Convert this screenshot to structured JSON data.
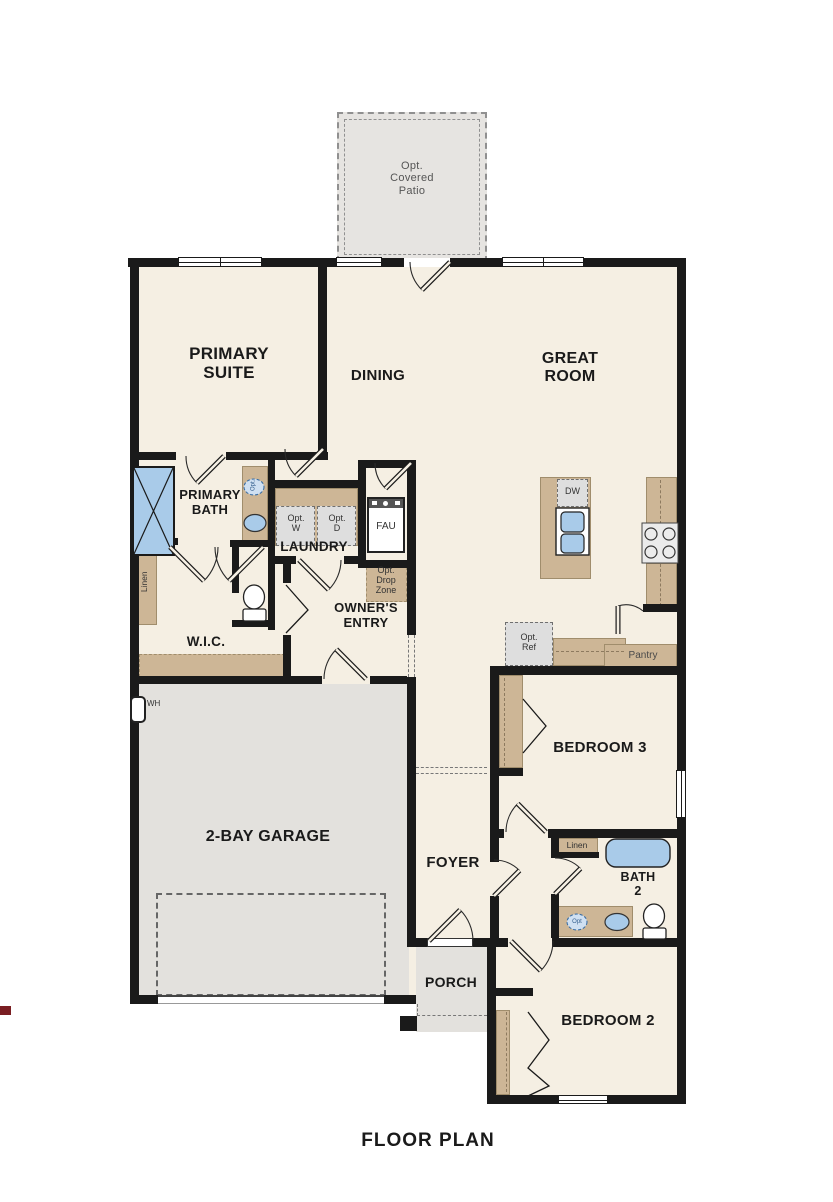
{
  "page": {
    "title": "FLOOR PLAN"
  },
  "colors": {
    "wall": "#1a1a1a",
    "room_fill": "#f5efe3",
    "garage_fill": "#e3e1dd",
    "porch_fill": "#e3e1dd",
    "patio_fill": "#e6e4e1",
    "cabinet_tan": "#cdb696",
    "optional_gray": "#dedede",
    "fixture_blue": "#a9cbe9",
    "optional_blue_outline": "#3a6ea5"
  },
  "rooms": {
    "patio": {
      "label": "Opt.\nCovered\nPatio"
    },
    "primary_suite": {
      "label": "PRIMARY\nSUITE"
    },
    "dining": {
      "label": "DINING"
    },
    "great_room": {
      "label": "GREAT\nROOM"
    },
    "primary_bath": {
      "label": "PRIMARY\nBATH"
    },
    "laundry": {
      "label": "LAUNDRY"
    },
    "wic": {
      "label": "W.I.C."
    },
    "owners_entry": {
      "label": "OWNER'S\nENTRY"
    },
    "garage": {
      "label": "2-BAY GARAGE"
    },
    "foyer": {
      "label": "FOYER"
    },
    "bedroom_3": {
      "label": "BEDROOM 3"
    },
    "bath_2": {
      "label": "BATH\n2"
    },
    "porch": {
      "label": "PORCH"
    },
    "bedroom_2": {
      "label": "BEDROOM 2"
    },
    "pantry": {
      "label": "Pantry"
    }
  },
  "fixtures": {
    "linen_primary": {
      "label": "Linen"
    },
    "linen_bath2": {
      "label": "Linen"
    },
    "opt_washer": {
      "label": "Opt.\nW"
    },
    "opt_dryer": {
      "label": "Opt.\nD"
    },
    "fau": {
      "label": "FAU"
    },
    "opt_drop_zone": {
      "label": "Opt.\nDrop\nZone"
    },
    "dishwasher": {
      "label": "DW"
    },
    "opt_refrigerator": {
      "label": "Opt.\nRef"
    },
    "water_heater": {
      "label": "WH"
    },
    "opt_sink_primary": {
      "label": "Opt."
    },
    "opt_sink_bath2": {
      "label": "Opt"
    }
  }
}
